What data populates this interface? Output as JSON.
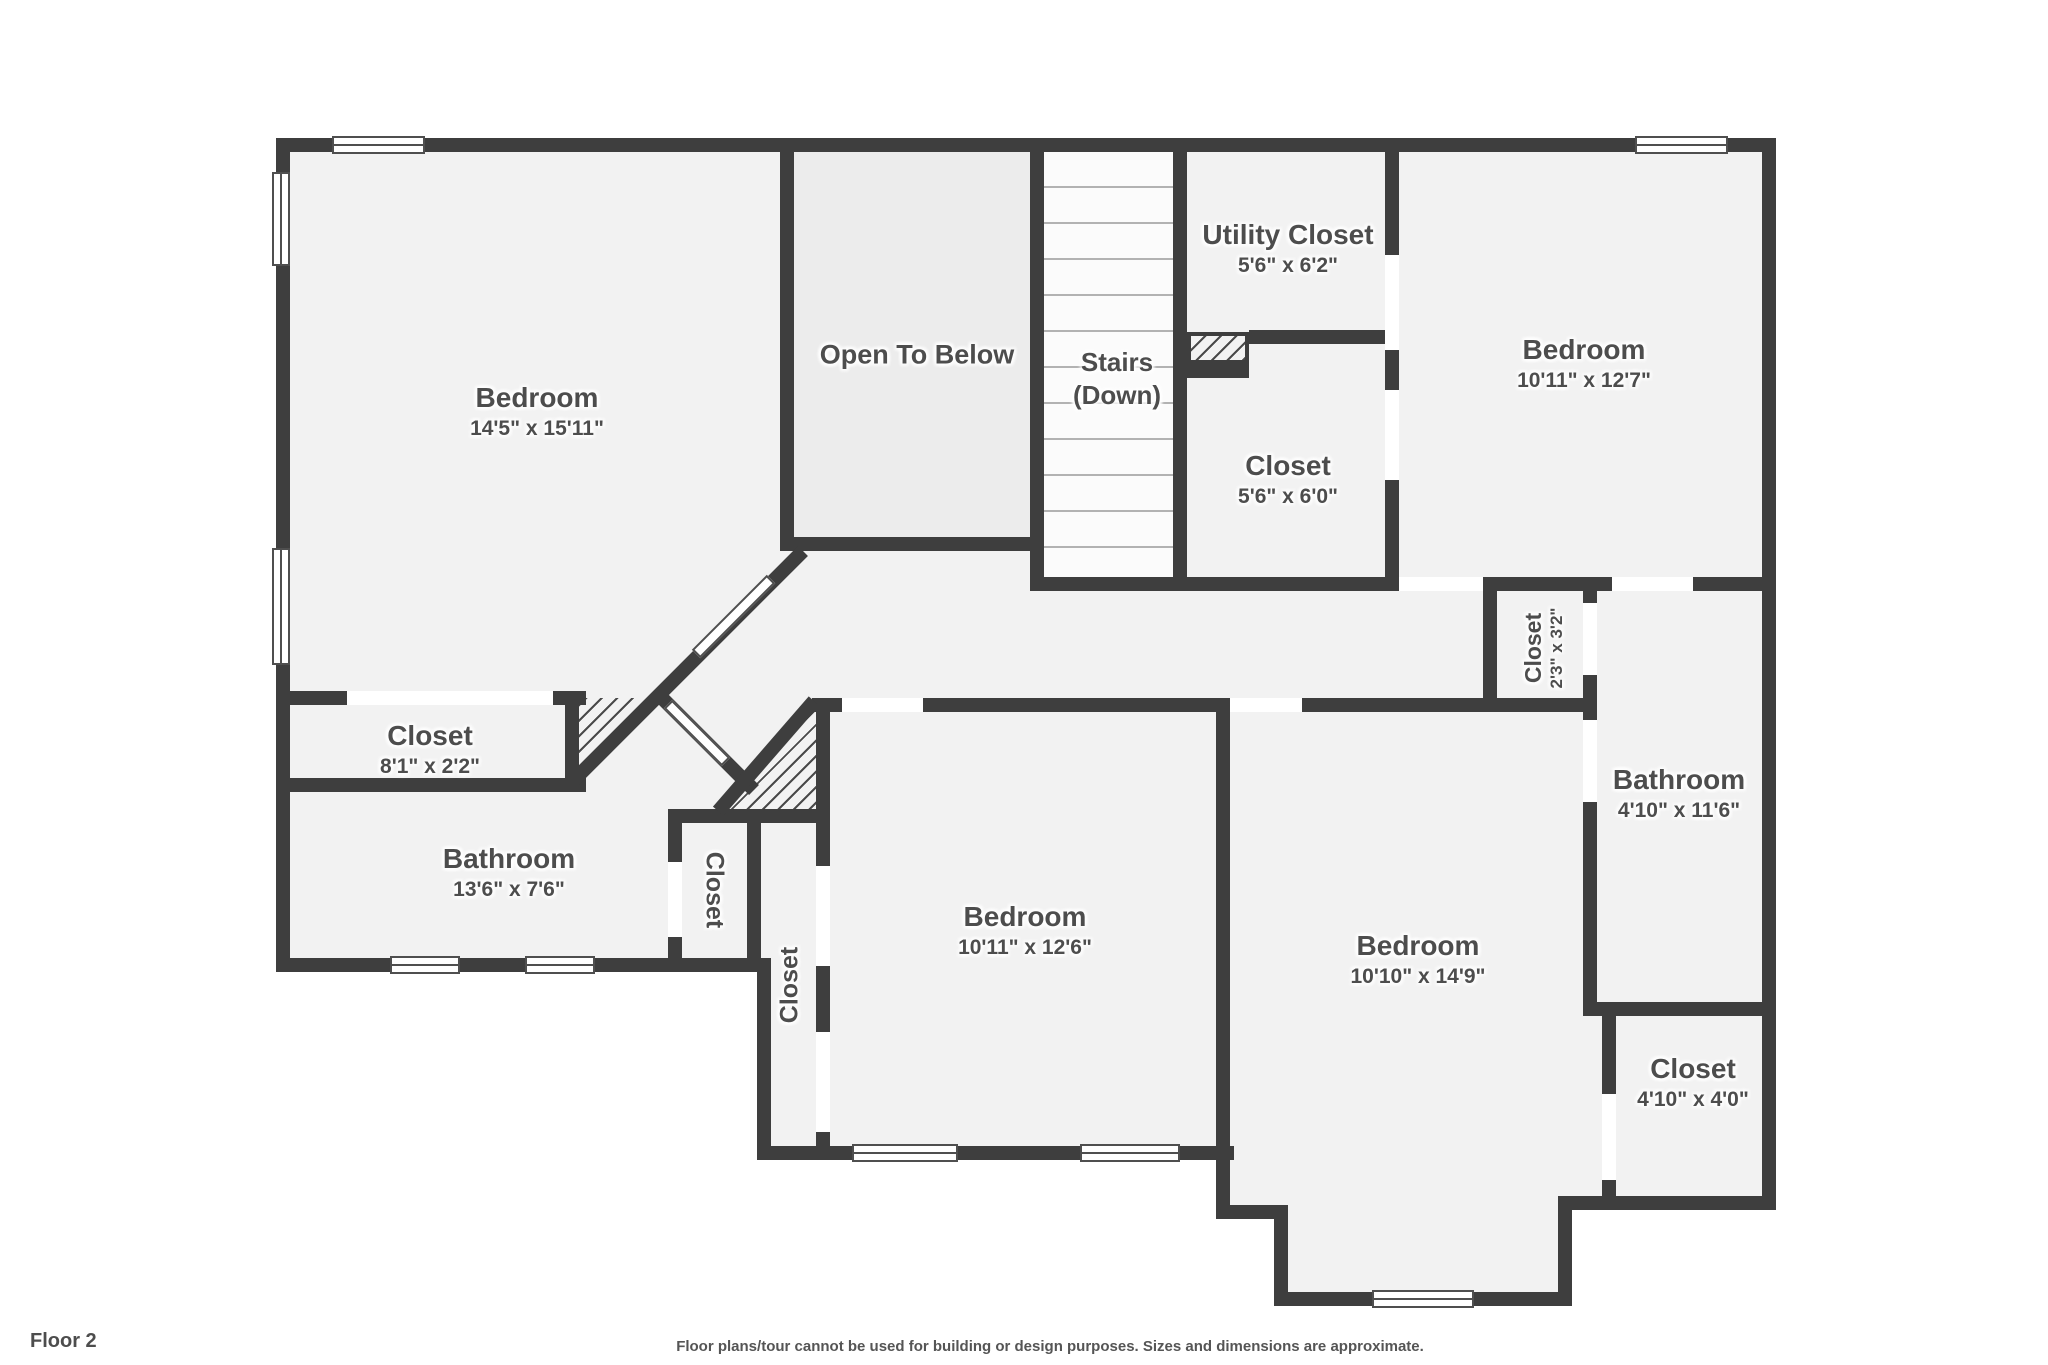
{
  "meta": {
    "view_title": "Floor 2 floor plan",
    "colors": {
      "wall": "#3e3e3e",
      "room_fill": "#f2f2f2",
      "open_to_below_fill": "#ececec",
      "label_text": "#4d4d4d",
      "outside": "#ffffff"
    }
  },
  "rooms": {
    "bedroom_tl": {
      "label": "Bedroom",
      "size": "14'5\" x 15'11\""
    },
    "open_below": {
      "label": "Open To Below"
    },
    "stairs": {
      "label": "Stairs",
      "size": "(Down)"
    },
    "utility": {
      "label": "Utility Closet",
      "size": "5'6\" x 6'2\""
    },
    "bedroom_tr": {
      "label": "Bedroom",
      "size": "10'11\" x 12'7\""
    },
    "closet_56": {
      "label": "Closet",
      "size": "5'6\" x 6'0\""
    },
    "closet_81": {
      "label": "Closet",
      "size": "8'1\" x 2'2\""
    },
    "bathroom_136": {
      "label": "Bathroom",
      "size": "13'6\" x 7'6\""
    },
    "closet_v1": {
      "label": "Closet"
    },
    "closet_v2": {
      "label": "Closet"
    },
    "bedroom_bm": {
      "label": "Bedroom",
      "size": "10'11\" x 12'6\""
    },
    "bedroom_br": {
      "label": "Bedroom",
      "size": "10'10\" x 14'9\""
    },
    "closet_23": {
      "label": "Closet",
      "size": "2'3\" x 3'2\""
    },
    "bathroom_410": {
      "label": "Bathroom",
      "size": "4'10\" x 11'6\""
    },
    "closet_410": {
      "label": "Closet",
      "size": "4'10\" x 4'0\""
    }
  },
  "footer": {
    "floor_label": "Floor 2",
    "disclaimer": "Floor plans/tour cannot be used for building or design purposes. Sizes and dimensions are approximate."
  }
}
